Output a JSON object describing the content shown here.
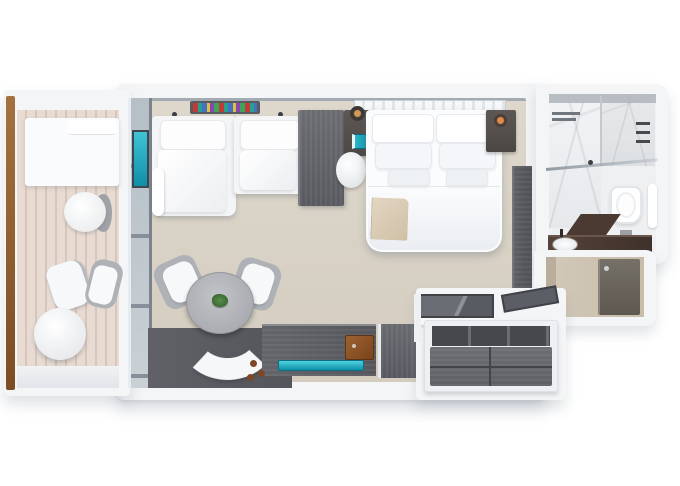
{
  "scene": {
    "type": "3d-floorplan-top-down-render",
    "description": "Top-down 3D rendering of a balcony suite stateroom floor plan, no text labels",
    "rooms": [
      {
        "name": "balcony",
        "items": [
          "daybed",
          "side-table",
          "lounge-chair",
          "two-bistro-chairs",
          "round-bistro-table",
          "wood-railing",
          "striped-decking"
        ]
      },
      {
        "name": "living-area",
        "items": [
          "l-shaped-sofa",
          "book-shelf",
          "media-cabinet",
          "round-dining-table",
          "two-dining-chairs",
          "curved-bench",
          "potted-plant",
          "dark-rug",
          "tv-console",
          "teal-tv-screen",
          "amenity-box",
          "minibar-cabinet",
          "sliding-glass-wall",
          "teal-artwork"
        ]
      },
      {
        "name": "bedroom",
        "items": [
          "king-bed",
          "striped-headboard",
          "nightstand-left",
          "nightstand-right",
          "pendant-lamp-left",
          "pendant-lamp-right",
          "teal-book",
          "round-stool",
          "beige-throw-blanket",
          "wardrobe"
        ]
      },
      {
        "name": "bathroom",
        "items": [
          "marble-shower",
          "glass-partition",
          "shower-fixtures",
          "towel-shelf",
          "toilet",
          "towel-rail",
          "stone-vanity",
          "sink",
          "faucet"
        ]
      },
      {
        "name": "entry",
        "items": [
          "entry-door",
          "door-handle",
          "hallway-floor"
        ]
      },
      {
        "name": "closet-corner",
        "items": [
          "glass-top-desk",
          "angled-shelf",
          "closet-island",
          "closet-drawers"
        ]
      }
    ]
  },
  "colors": {
    "wall": "#f3f5f7",
    "floor-a": "#ded8cc",
    "floor-b": "#d3ccbf",
    "deck-a": "#e7dbd2",
    "deck-b": "#d8c6bc",
    "wood-b": "#595a60",
    "wood-brown": "#a5713f",
    "rug": "#54555b",
    "teal-b": "#0f8fa8",
    "glass": "#b6bfc6",
    "table-gray": "#a9abb0",
    "plant": "#2f5c2b",
    "copper": "#e08c4a",
    "throw": "#cfbfa6",
    "marble-a": "#f2f3f5",
    "vanity": "#3f312b",
    "door": "#5d5850"
  }
}
